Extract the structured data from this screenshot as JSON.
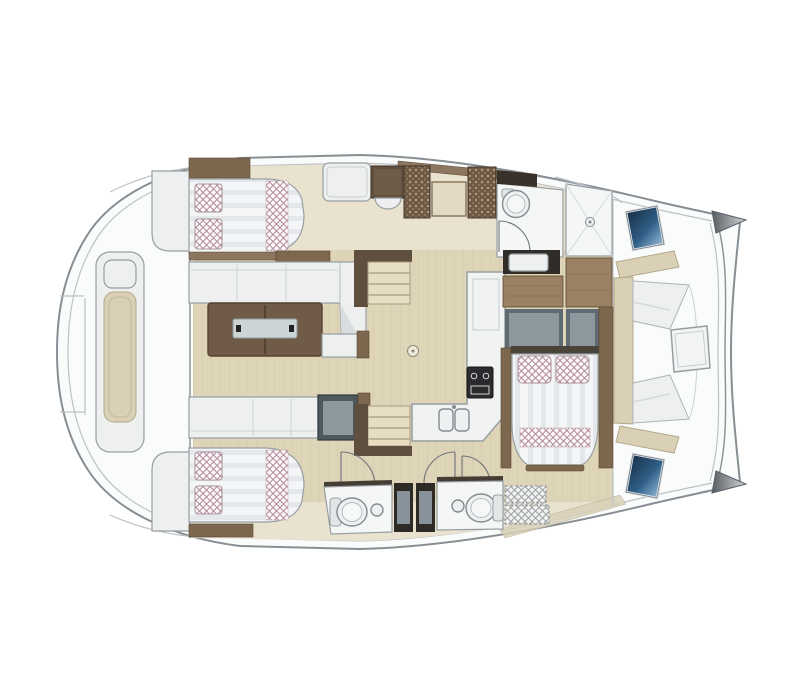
{
  "diagram": {
    "type": "yacht-floor-plan",
    "vessel": "catamaran",
    "orientation": "bow-right",
    "elements": [
      "hull",
      "bow-tips",
      "stern-deck",
      "aft-bench",
      "port-forward-cabin-bed",
      "port-aft-cabin-bed",
      "salon-sofa",
      "salon-corner-seat",
      "salon-table",
      "tv-cabinet",
      "galley-counter",
      "stove",
      "double-sink",
      "cabinet-row",
      "wicker-lockers",
      "stairs-forward",
      "stairs-aft",
      "toilet-room",
      "shower-room",
      "deck-hatch-window-top",
      "deck-hatch-window-bottom",
      "owner-cabin-vanity",
      "owner-cabin-wardrobes",
      "owner-cabin-bed",
      "aft-bathroom-port",
      "aft-bathroom-starboard",
      "bathroom-doors",
      "storage-hatch",
      "forward-cockpit-seating",
      "forward-cockpit-table"
    ]
  },
  "palette": {
    "hull_fill": "#fafbfb",
    "hull_stroke": "#878e94",
    "line_light": "#bcc2c6",
    "seam": "#ced2d4",
    "floor_light": "#e9e2cf",
    "floor_wood": "#ded4b8",
    "floor_grain": "#d2c7a6",
    "wood_dark": "#5f4f3f",
    "wood_mid": "#7d684f",
    "wood_light": "#9b8164",
    "wood_strip": "#8d7660",
    "wood_edge": "#57452f",
    "wicker_base": "#6e5a45",
    "wicker_dot": "#c8b28d",
    "white_furn": "#eef0ef",
    "furn_stroke": "#979ea3",
    "room_white": "#f5f7f6",
    "cushion_beige": "#d9d0b6",
    "cushion_stroke": "#b3a88d",
    "check_pink": "#b48f9d",
    "check_bg": "#fdf9fa",
    "check_gray": "#9aa1a6",
    "stripe_light": "#f4f5f6",
    "stripe_dark": "#dde0e4",
    "gray_box": "#4e585f",
    "gray_inner": "#8c979e",
    "wardrobe_dark": "#5f6a72",
    "dark_panel": "#2e2a26",
    "dark_bar": "#39322a",
    "table_wood": "#6f5b48",
    "table_edge": "#55432f",
    "table_inset": "#ccd5d5",
    "stove_body": "#2b2b2d",
    "stove_lines": "#cfd3d5",
    "fixture_fill": "#edf0f0",
    "fixture_stroke": "#848c91",
    "blue_dark": "#14273c",
    "blue_mid": "#2f5e86",
    "blue_light": "#a9cce8",
    "beak_dark": "#585e63",
    "beak_light": "#cfd4d7",
    "door_arc": "#6f7478",
    "shadow_tri": "#dadddf"
  }
}
